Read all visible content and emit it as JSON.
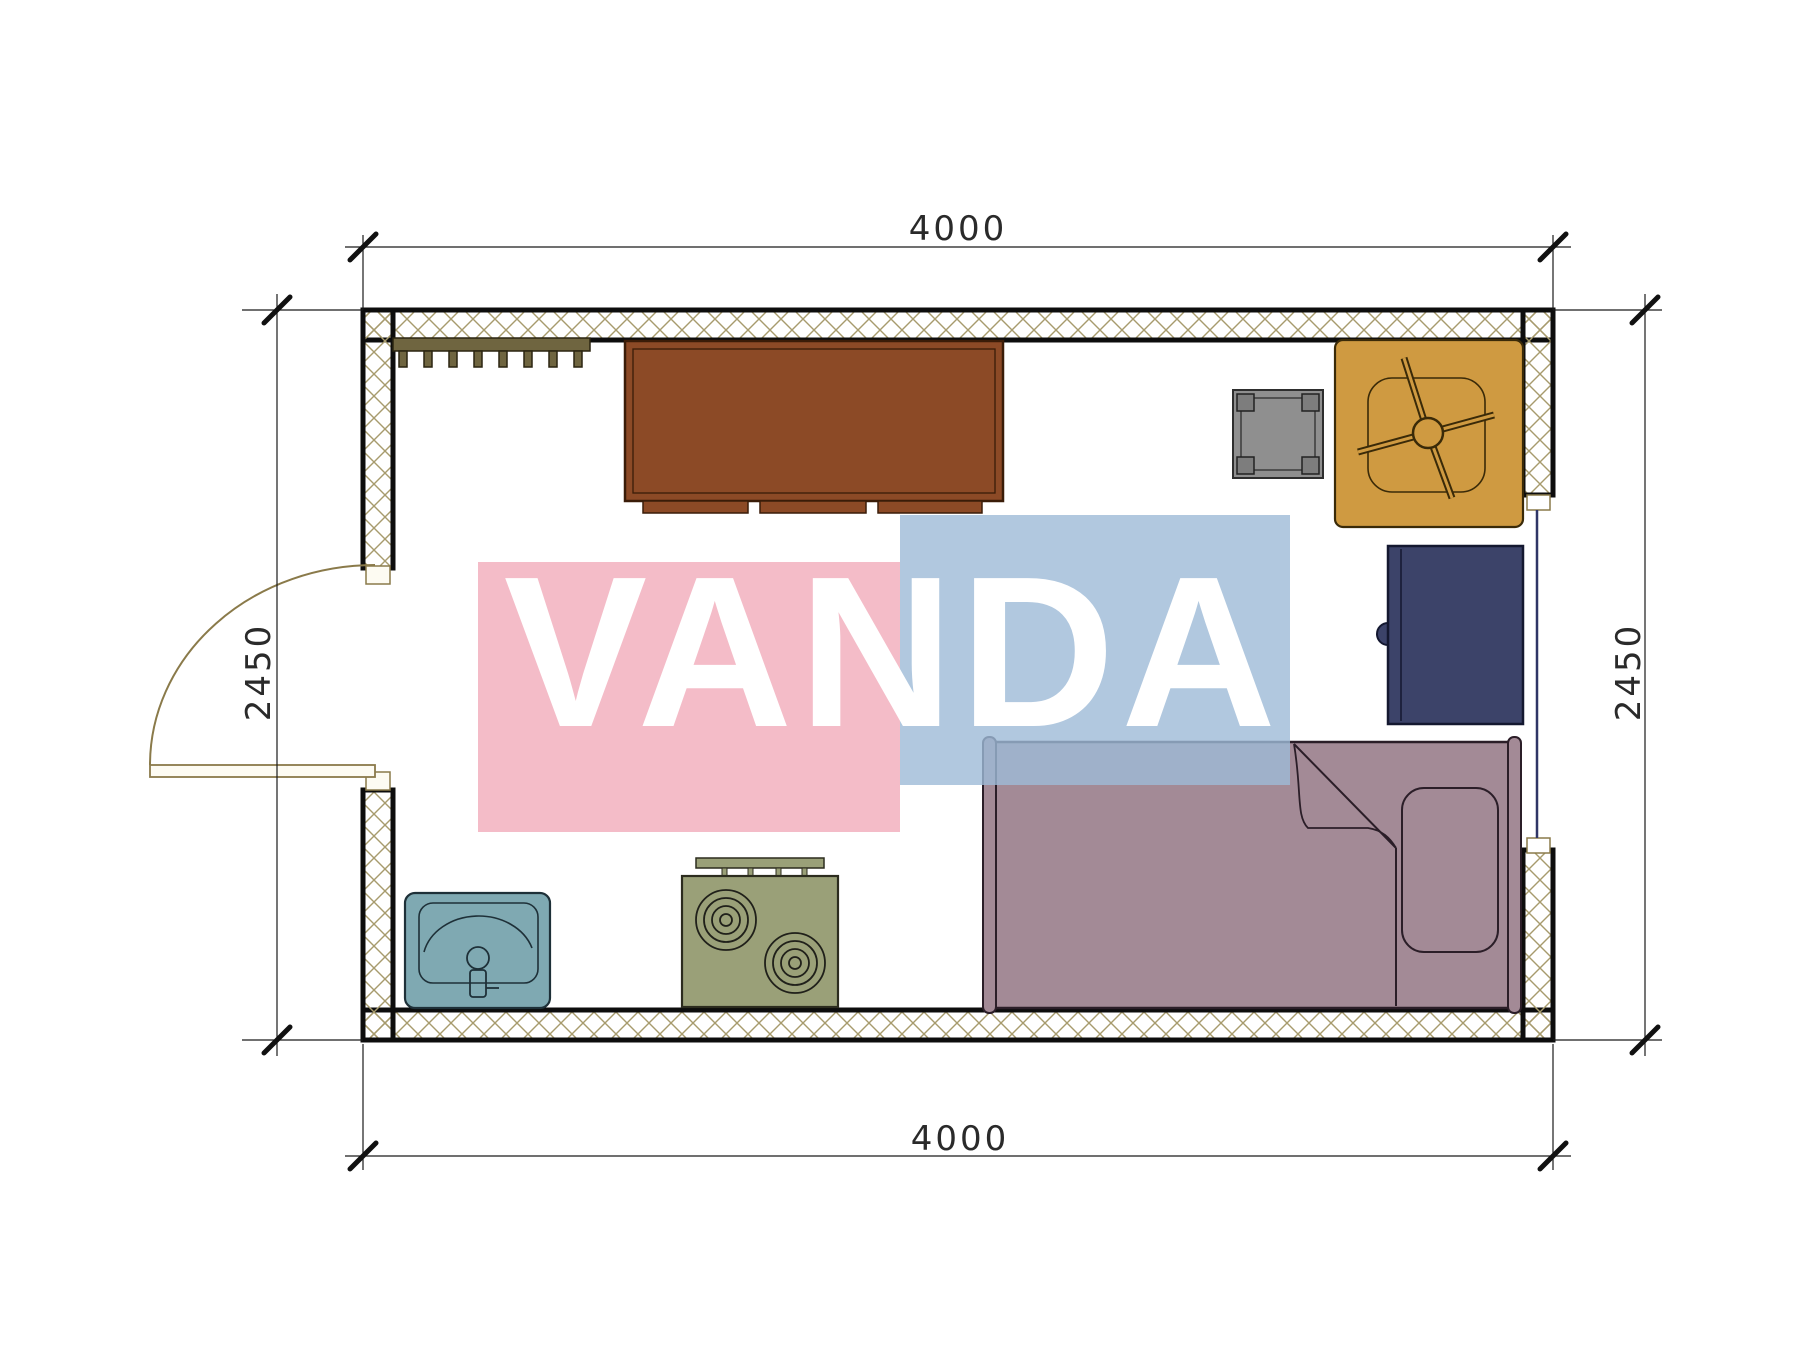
{
  "drawing_type": "apartment-studio-floor-plan",
  "watermark": {
    "text": "VANDA",
    "pink_fill": "rgba(240,160,176,0.70)",
    "blue_fill": "rgba(158,186,215,0.80)",
    "text_color": "#ffffff"
  },
  "dimensions": {
    "top": "4000",
    "bottom": "4000",
    "left": "2450",
    "right": "2450"
  },
  "colors": {
    "wall_hatch": "#a79b6d",
    "wall_fill": "#fdfcf7",
    "wall_outline": "#0d0d0d",
    "door_stroke": "#8a7a4a",
    "door_fill": "#fdfbf2",
    "window_line": "#2f3566",
    "coat_rack": "#6f6540",
    "desk": "#8c4a26",
    "desk_outline": "#3a1c08",
    "stool": "#8f8f8f",
    "stool_leg": "#7d7d7d",
    "chair": "#cf9a41",
    "chair_outline": "#3a2a08",
    "cabinet": "#3c4369",
    "cabinet_outline": "#141830",
    "bed": "#a38a96",
    "bed_outline": "#2b1e28",
    "sink": "#7fa9b2",
    "sink_outline": "#1e3038",
    "stove": "#9aa078",
    "stove_outline": "#2c2c1e"
  },
  "furniture": [
    "coat-rack",
    "desk",
    "stool",
    "office-chair",
    "cabinet",
    "single-bed",
    "sink",
    "two-burner-stove"
  ],
  "openings": [
    "door-left-wall",
    "window-right-wall"
  ]
}
